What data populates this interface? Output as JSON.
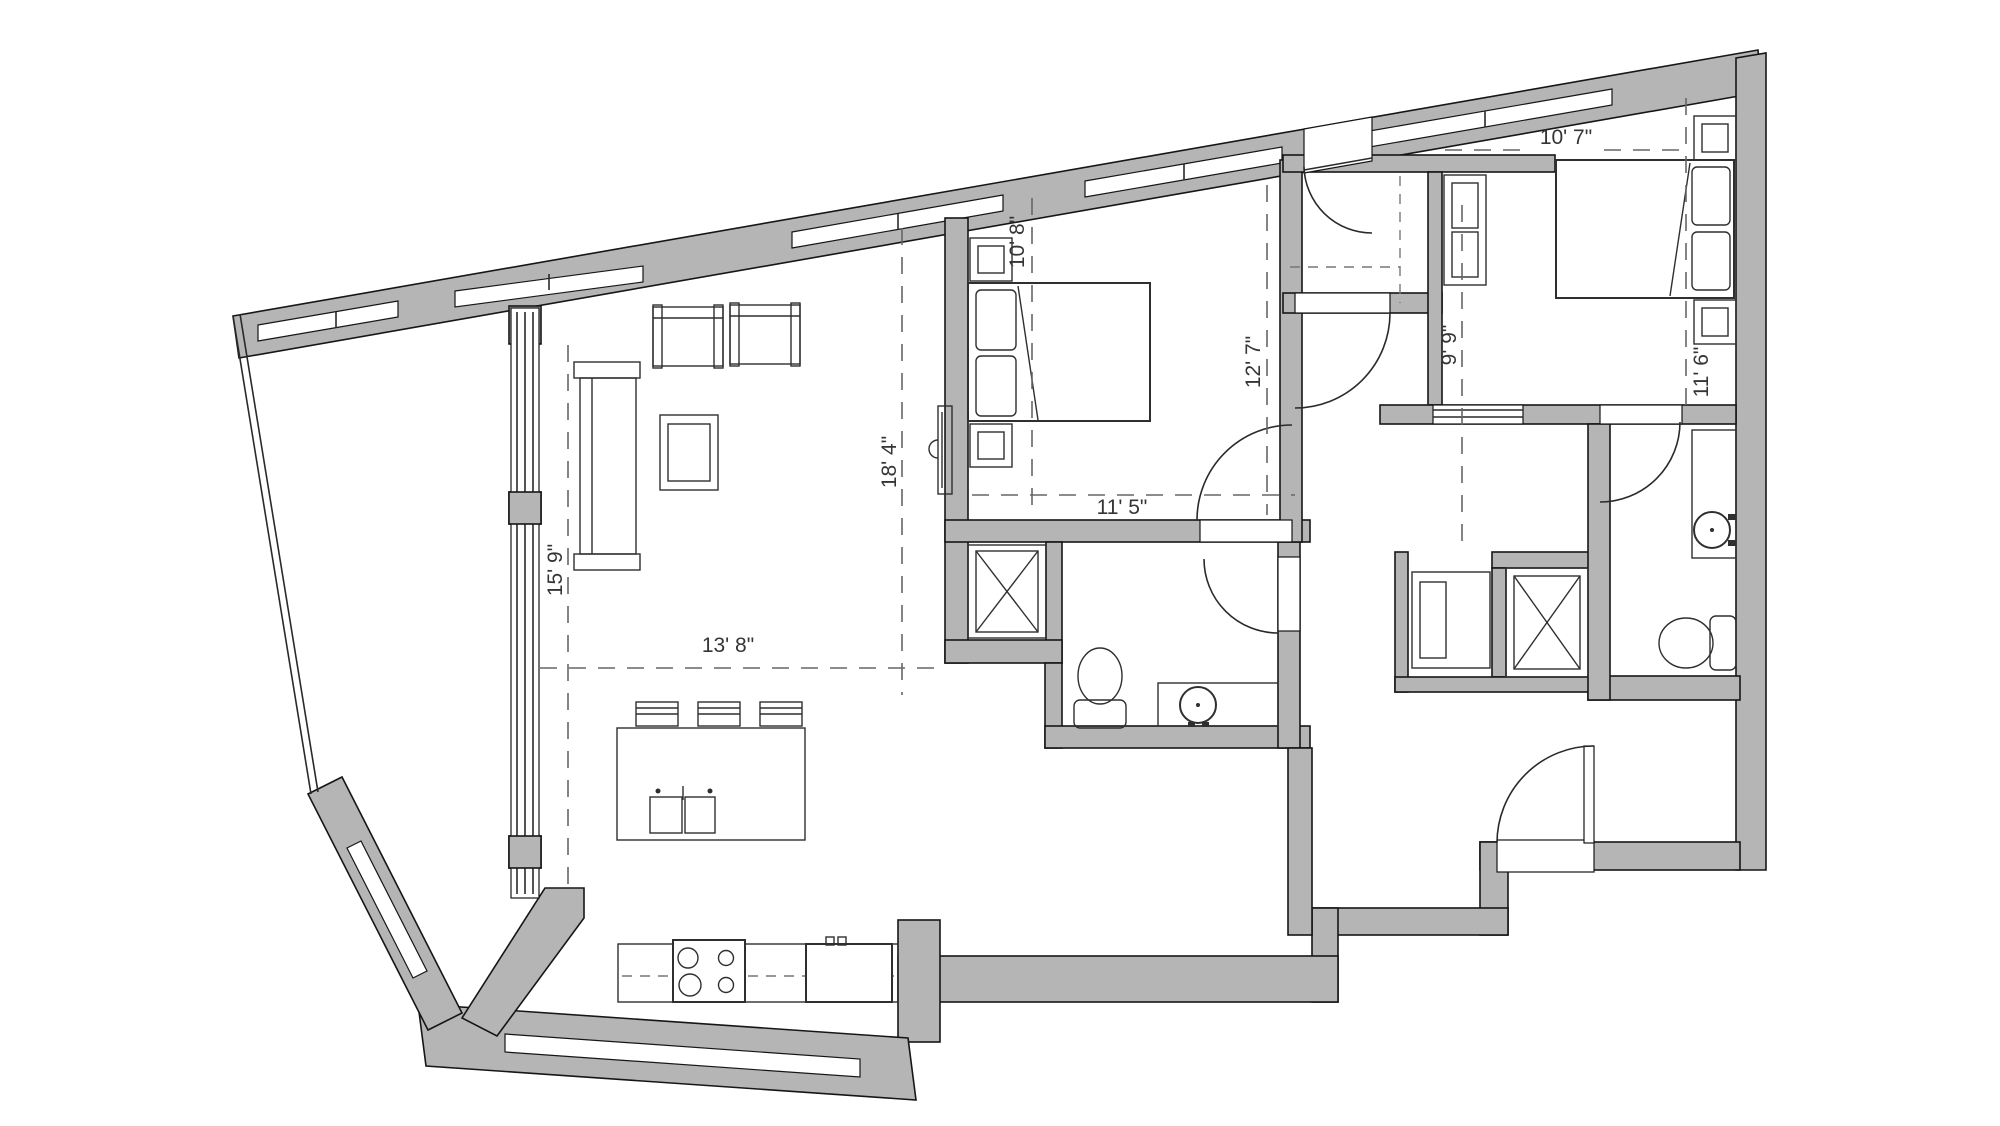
{
  "plan_type": "apartment-floor-plan",
  "colors": {
    "wall_fill": "#b5b5b5",
    "outline": "#161616",
    "dimension_text": "#353535",
    "dash": "#666666",
    "floor": "#ffffff"
  },
  "dimensions": [
    {
      "id": "living-width",
      "label": "15' 9\""
    },
    {
      "id": "living-depth",
      "label": "13' 8\""
    },
    {
      "id": "living-length",
      "label": "18' 4\""
    },
    {
      "id": "bedroom2-width",
      "label": "10' 8\""
    },
    {
      "id": "bedroom2-length",
      "label": "11' 5\""
    },
    {
      "id": "bedroom2-height",
      "label": "12' 7\""
    },
    {
      "id": "hall-width",
      "label": "9' 9\""
    },
    {
      "id": "bedroom1-width",
      "label": "10' 7\""
    },
    {
      "id": "bedroom1-length",
      "label": "11' 6\""
    }
  ],
  "fixtures": [
    "sofa",
    "armchair",
    "coffee-table",
    "tv",
    "kitchen-island",
    "bar-stool",
    "double-sink",
    "range",
    "refrigerator",
    "bed",
    "nightstand",
    "dresser",
    "toilet",
    "bathroom-sink",
    "washer-dryer",
    "shaft-closet",
    "door-swing",
    "window"
  ]
}
